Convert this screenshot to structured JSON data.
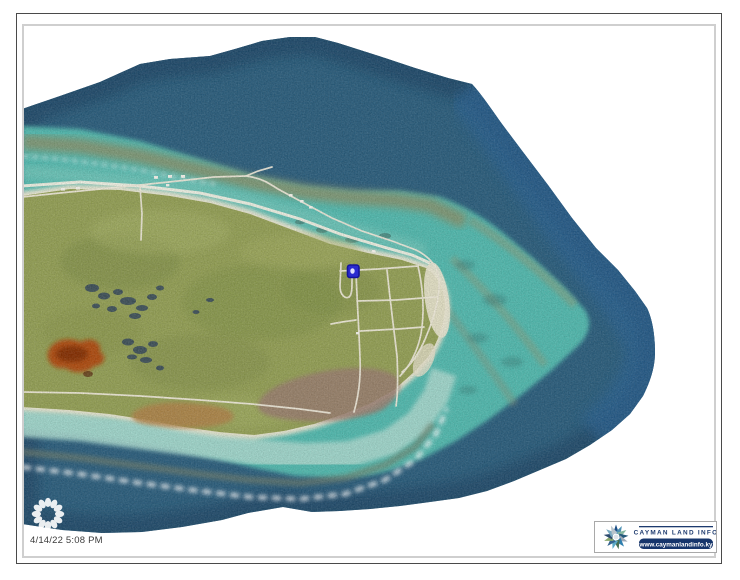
{
  "map": {
    "timestamp": "4/14/22 5:08 PM",
    "view": "aerial-orthophoto-island-east-end",
    "colors": {
      "ocean_deep": "#2c5f7e",
      "ocean_edge_dark": "#1b4160",
      "ocean_right_blue": "#2b6494",
      "lagoon_turquoise": "#53bbb0",
      "lagoon_nearshore": "#7fccbf",
      "south_bank_pale": "#aadbd0",
      "reef_crest_brown": "#8d9068",
      "island_green": "#95a156",
      "beach_sand": "#ece8d3",
      "road_white": "#f0ebdb",
      "pond_dark": "#33465c",
      "pond_brown": "#b08448",
      "pond_mauve": "#9b7e70",
      "red_patch": "#b24a10",
      "parcel_marker_blue": "#2a2ad0"
    }
  },
  "branding": {
    "title": "CAYMAN LAND INFO",
    "url": "www.caymanlandinfo.ky",
    "navy": "#16356b"
  },
  "icons": {
    "spinner": "loading-spinner-icon",
    "logo": "cayman-land-info-starburst",
    "marker": "selected-parcel-marker"
  }
}
